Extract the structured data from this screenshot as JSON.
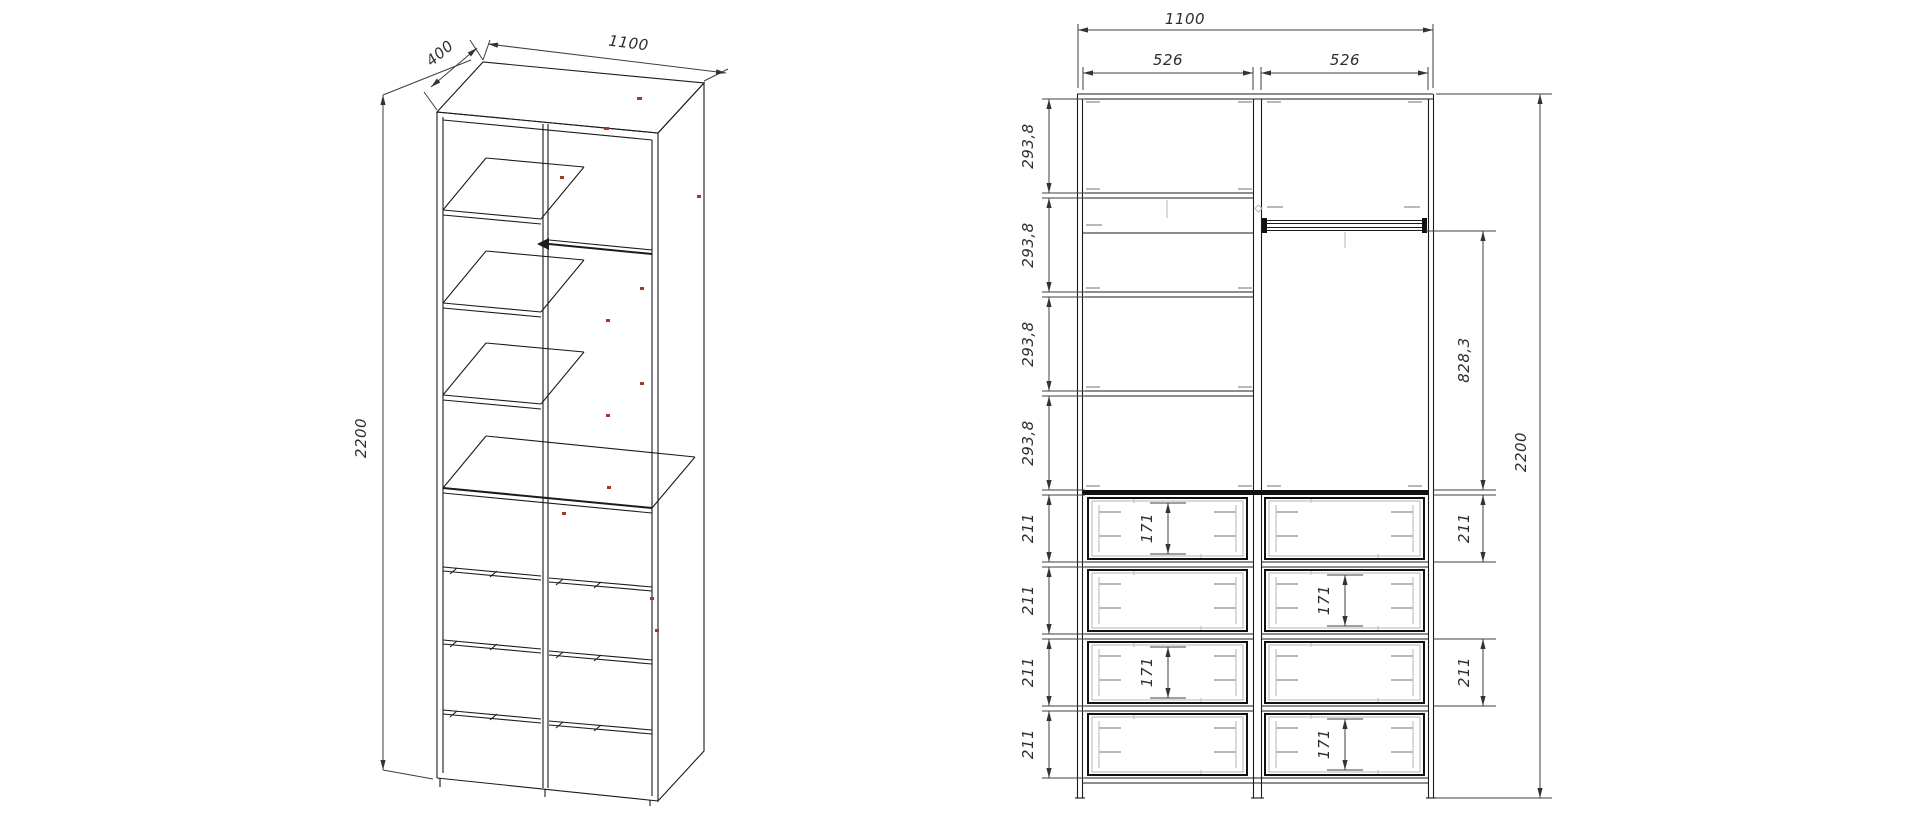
{
  "drawing_title": "Wardrobe assembly drawing",
  "colors": {
    "background": "#ffffff",
    "line": "#1b1b1b",
    "dimension": "#2e2e2e",
    "hardware": "#b8b8b8",
    "assembly_mark": "#a23a2a"
  },
  "perspective_view": {
    "depth": "400",
    "width": "1100",
    "height": "2200"
  },
  "front_view": {
    "top": {
      "overall": "1100",
      "left": "526",
      "right": "526"
    },
    "left_chain": [
      "293,8",
      "293,8",
      "293,8",
      "293,8",
      "211",
      "211",
      "211",
      "211"
    ],
    "drawer_inner": [
      "171",
      "171",
      "171",
      "171"
    ],
    "right_chain": {
      "hang": "828,3",
      "d1": "211",
      "d3": "211",
      "total": "2200"
    }
  }
}
